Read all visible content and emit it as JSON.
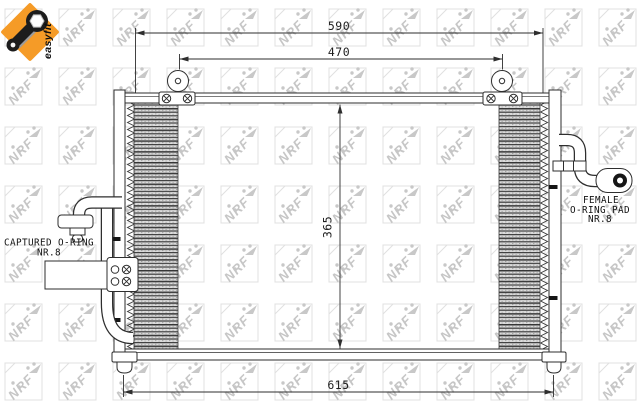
{
  "badge": {
    "label": "easyfit",
    "background_color": "#f59b27",
    "icon": "wrench-icon"
  },
  "watermark": {
    "text": "NRF",
    "color": "#c8c8c8"
  },
  "dimensions": {
    "overall_width": "590",
    "mounting_width": "470",
    "core_height": "365",
    "bottom_width": "615"
  },
  "labels": {
    "captured_oring": {
      "line1": "CAPTURED O-RING",
      "line2": "NR.8"
    },
    "female_pad": {
      "line1": "FEMALE",
      "line2": "O-RING PAD",
      "line3": "NR.8"
    }
  },
  "drawing": {
    "line_color": "#2e2e2e",
    "fin_dark": "#3e3e3e",
    "fin_light": "#dcdcdc"
  }
}
